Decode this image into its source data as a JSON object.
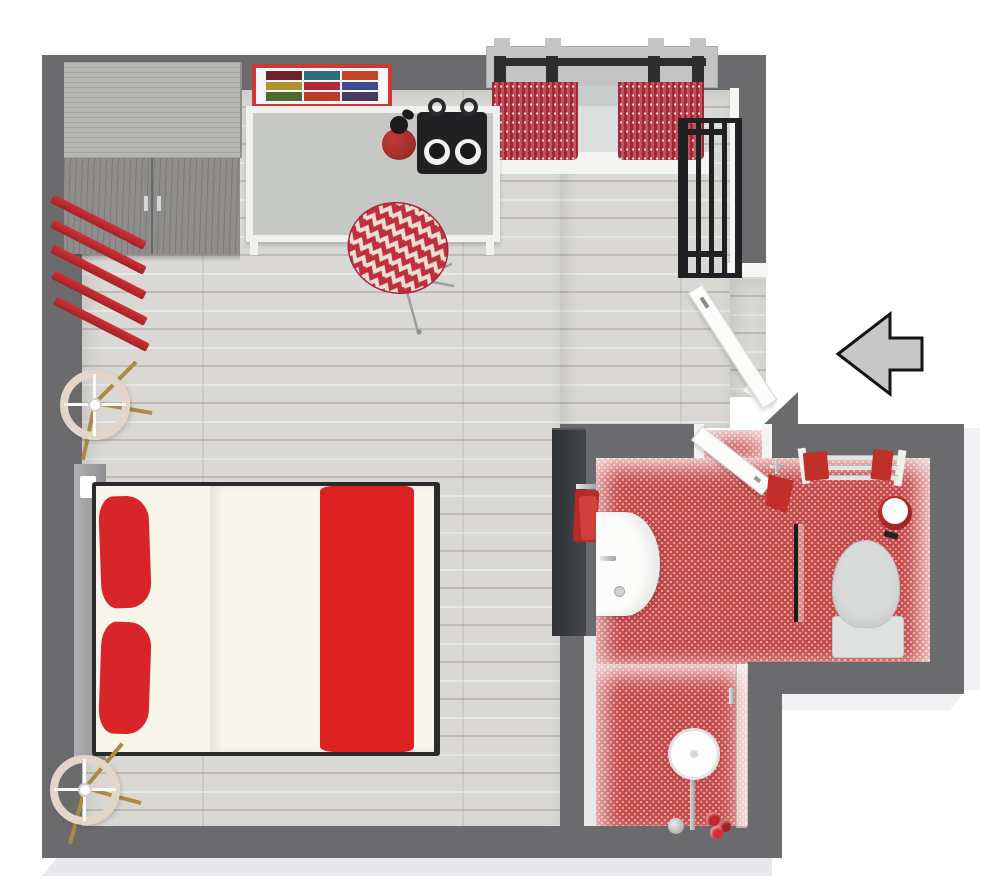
{
  "meta": {
    "title": "3D floor plan - studio apartment with red accent decor",
    "view": "top-down 3D render",
    "entrance_arrow_direction": "left"
  },
  "colors": {
    "wall": "#6b6b6d",
    "foundation": "#e7e7ed",
    "wood": "#d9d8d5",
    "tileBg": "#f1dbd9",
    "tileDot": "#c64b4b",
    "accentRed": "#d42027",
    "bedRed": "#dc2122",
    "pillowRed": "#d8252a",
    "cream": "#f8f5ec",
    "counterTop": "#c6c8c6",
    "counterFrame": "#f1f1ef",
    "darkAppliance": "#212124",
    "chrome": "#b9bcbd",
    "brass": "#ab8b41",
    "arrowFill": "#c7c7c7",
    "curtainA": "#9e2836",
    "curtainB": "#c4505c",
    "frameRed": "#cf3636",
    "wardrobeTop": "#b5b5b3",
    "wardrobeFront": "#8e8d8b",
    "lampShade": "#e3d6c8",
    "headboard": "#a3a3a5",
    "tvPanel": "#34373b",
    "fixtureGray": "#d9dbdb",
    "doorWhite": "#fbfbfa"
  },
  "rooms": [
    {
      "name": "main-room",
      "floor": "light wood planks",
      "contents": [
        "wardrobe",
        "gallery-frame",
        "kitchen-counter",
        "cooktop",
        "kettle",
        "chevron-chair",
        "window-curtains",
        "radiator",
        "wall-shelves",
        "floor-lamp-top",
        "floor-lamp-bottom",
        "double-bed",
        "tv-panel"
      ]
    },
    {
      "name": "bathroom",
      "floor": "red penny tile",
      "contents": [
        "sink-vanity",
        "hand-towels",
        "bathroom-door",
        "towel-rail",
        "waste-bin",
        "toilet",
        "glass-partition",
        "shower-head",
        "shower-valve",
        "shampoo-bottles"
      ]
    }
  ],
  "art_tiles": [
    "#6e2430",
    "#2f6e7e",
    "#c2452a",
    "#b0922f",
    "#b3273d",
    "#3d4b8f",
    "#4f6b2d",
    "#bf3b2a",
    "#4a3a5e"
  ],
  "counts": {
    "floor_lamps": 2,
    "wall_shelves": 5,
    "curtain_panels": 2,
    "towel_rail_bars": 3,
    "shampoo_bottles": 3
  }
}
